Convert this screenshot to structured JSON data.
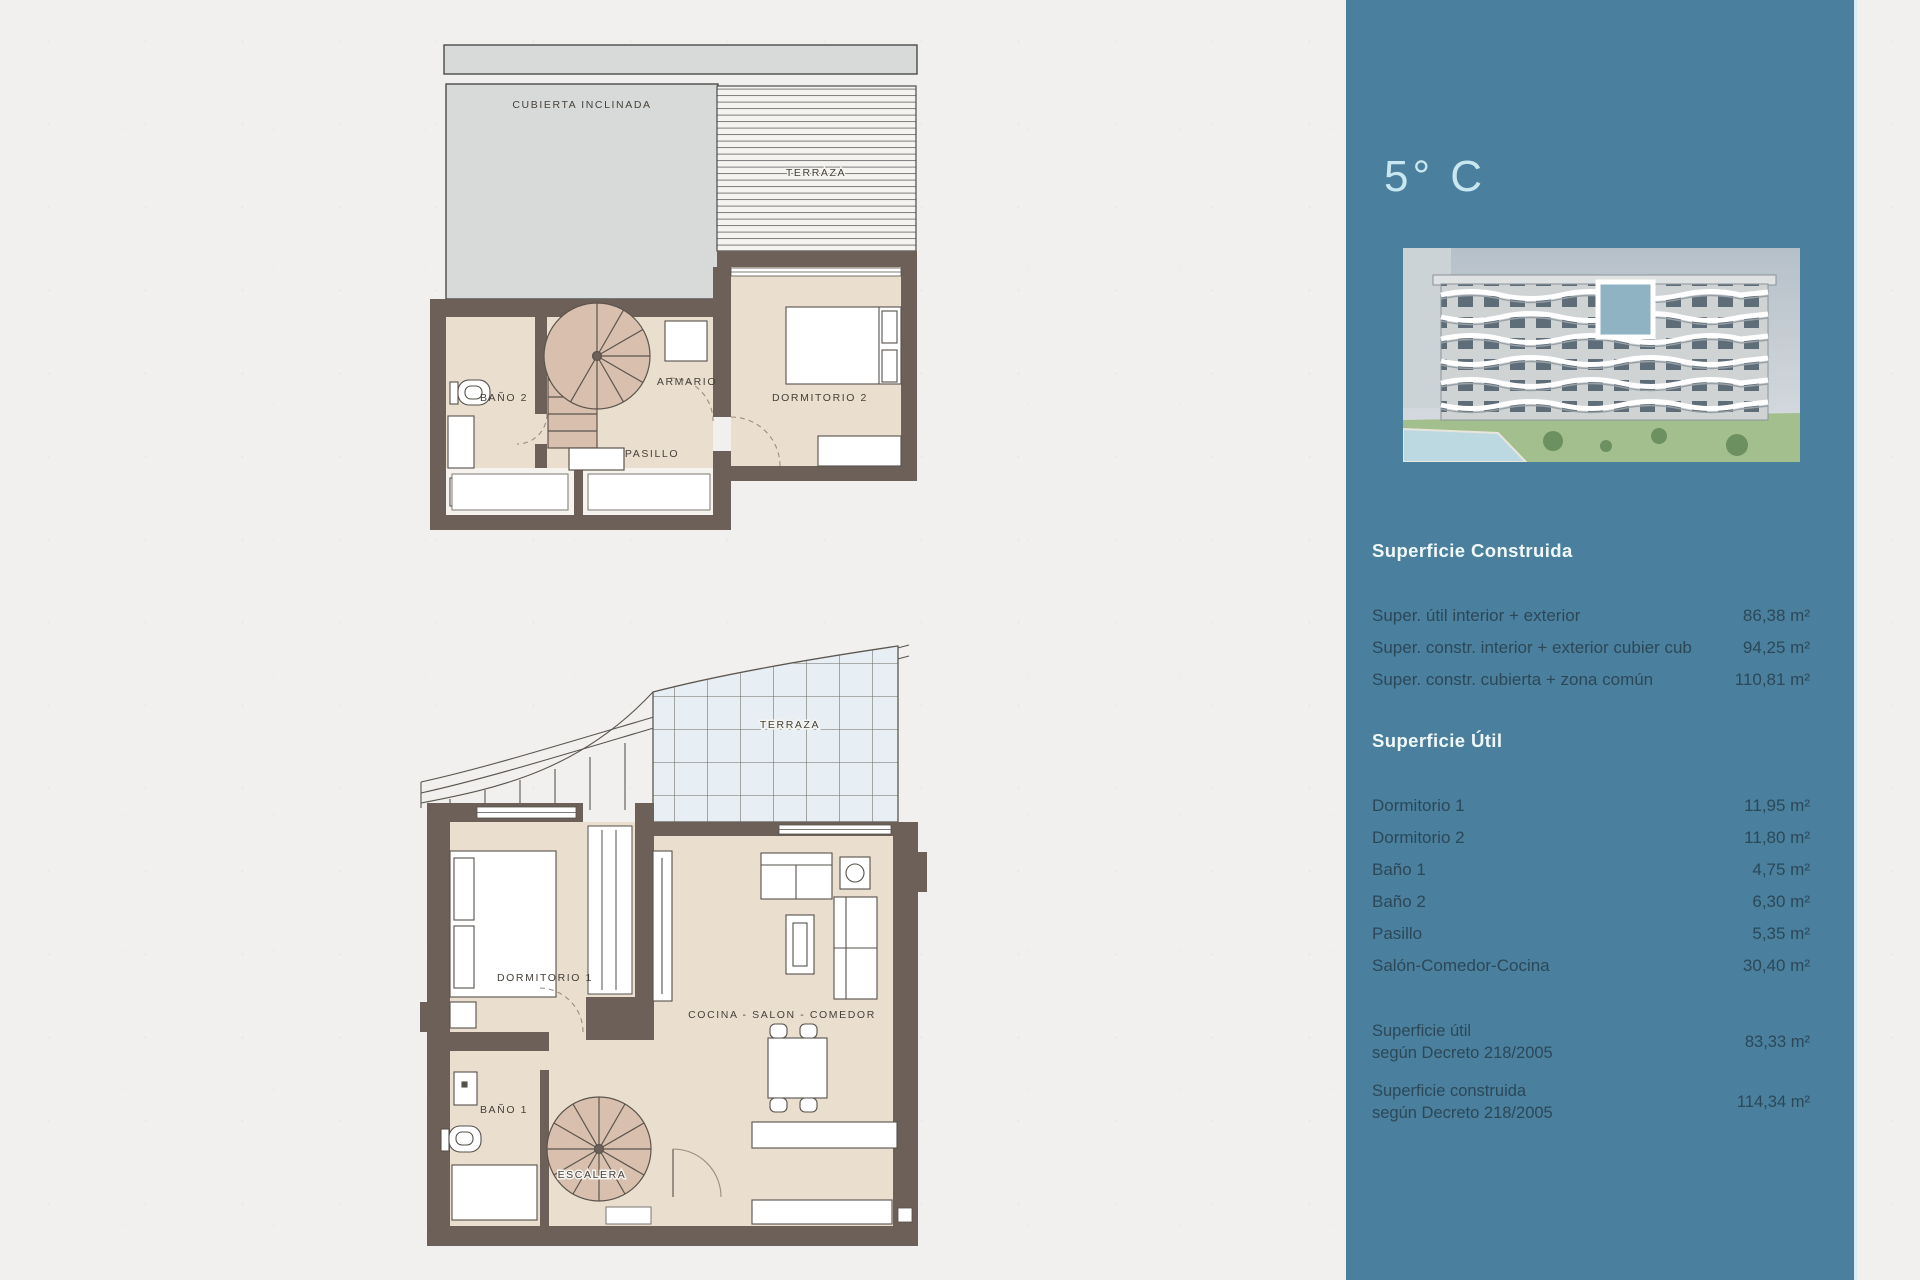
{
  "sidebar": {
    "title": "5° C",
    "construida": {
      "heading": "Superficie Construida",
      "rows": [
        {
          "label": "Super. útil interior + exterior",
          "value": "86,38 m²"
        },
        {
          "label": "Super. constr. interior + exterior cubier cub",
          "value": "94,25 m²"
        },
        {
          "label": "Super. constr. cubierta + zona común",
          "value": "110,81 m²"
        }
      ]
    },
    "util": {
      "heading": "Superficie Útil",
      "rows": [
        {
          "label": "Dormitorio 1",
          "value": "11,95 m²"
        },
        {
          "label": "Dormitorio 2",
          "value": "11,80 m²"
        },
        {
          "label": "Baño 1",
          "value": "4,75 m²"
        },
        {
          "label": "Baño 2",
          "value": "6,30 m²"
        },
        {
          "label": "Pasillo",
          "value": "5,35 m²"
        },
        {
          "label": "Salón-Comedor-Cocina",
          "value": "30,40 m²"
        }
      ]
    },
    "decreto": {
      "rows": [
        {
          "label_line1": "Superficie útil",
          "label_line2": "según Decreto 218/2005",
          "value": "83,33 m²"
        },
        {
          "label_line1": "Superficie construida",
          "label_line2": "según Decreto 218/2005",
          "value": "114,34 m²"
        }
      ]
    }
  },
  "plan_upper": {
    "labels": {
      "cubierta": "CUBIERTA INCLINADA",
      "terraza": "TERRAZA",
      "bano2": "BAÑO 2",
      "armario": "ARMARIO",
      "dormitorio2": "DORMITORIO 2",
      "pasillo": "PASILLO"
    }
  },
  "plan_lower": {
    "labels": {
      "terraza": "TERRAZA",
      "dormitorio1": "DORMITORIO 1",
      "bano1": "BAÑO 1",
      "escalera": "ESCALERA",
      "cocina": "COCINA - SALON - COMEDOR"
    }
  },
  "colors": {
    "sidebar_bg": "#4a7f9d",
    "paper": "#f1f0ee",
    "wall": "#6d6059",
    "floor": "#eadfce",
    "stair": "#d9c0ae",
    "roof_gray": "#d8dada",
    "glass": "#e7eef4",
    "title_text": "#c9e7f0",
    "heading_text": "#f0f8fa",
    "row_text": "#2b4859",
    "highlight_unit": "#8fb3c2"
  }
}
